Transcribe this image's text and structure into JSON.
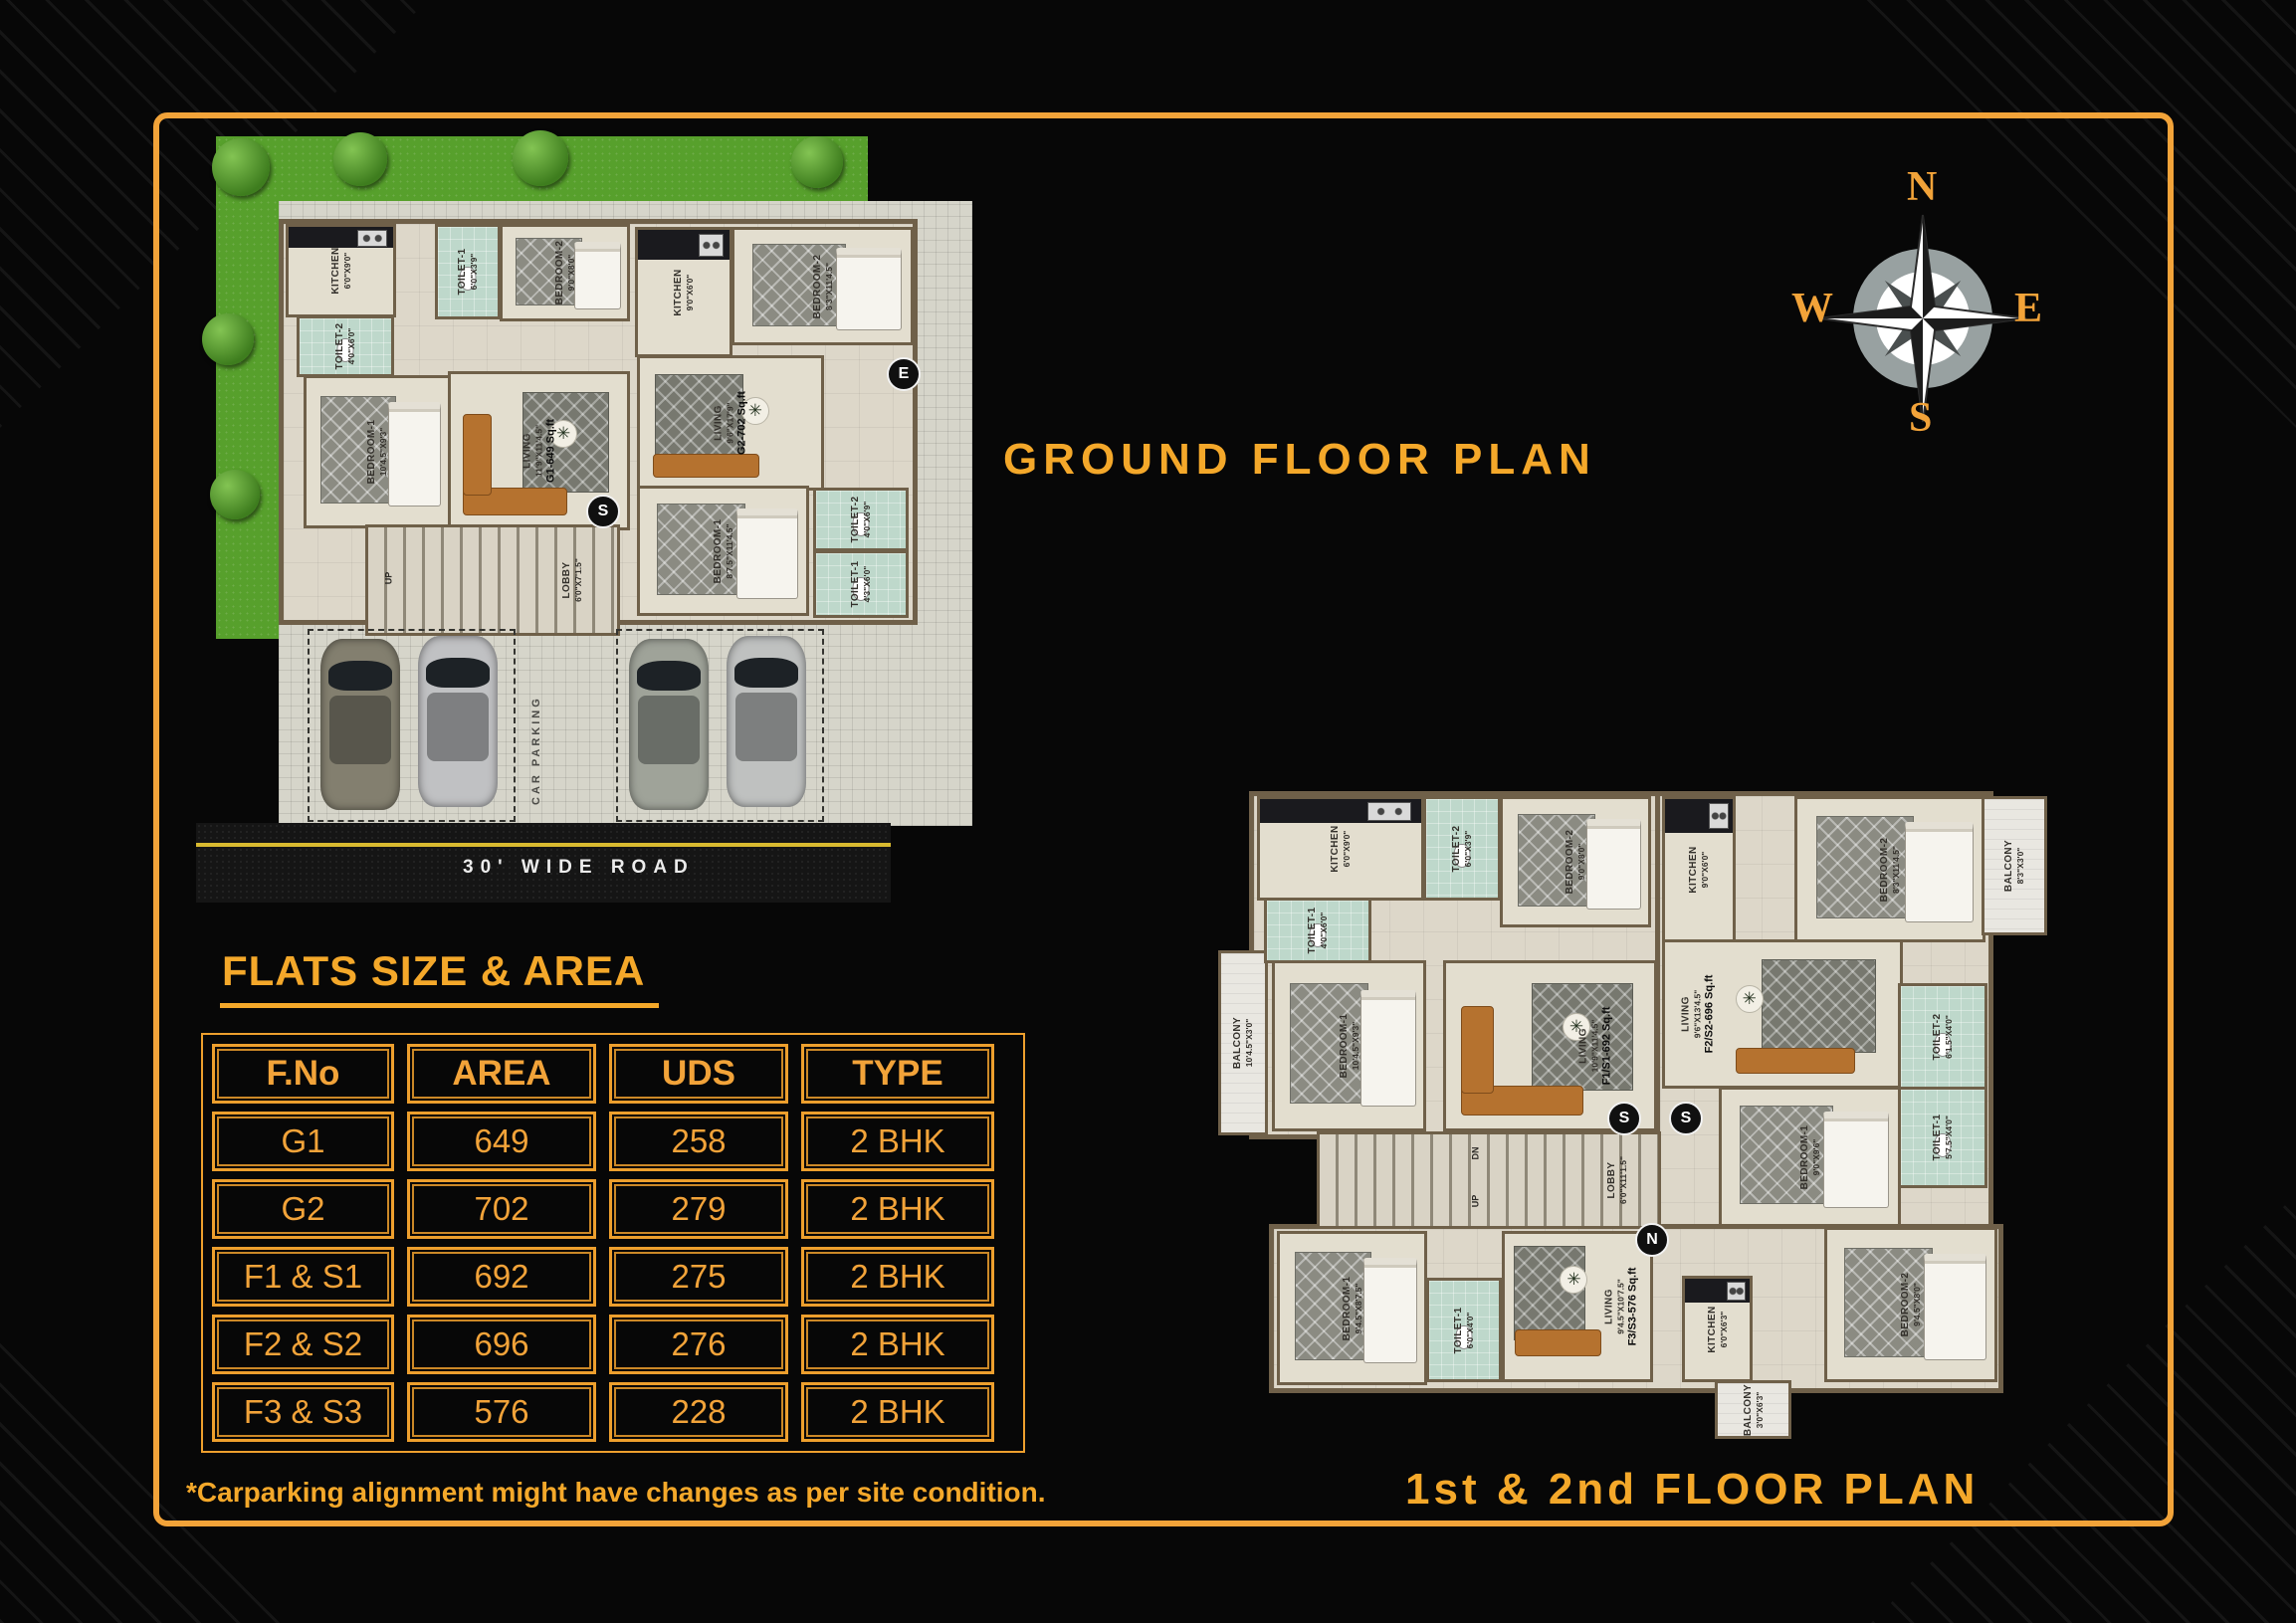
{
  "titles": {
    "ground": "GROUND FLOOR PLAN",
    "upper": "1st & 2nd FLOOR PLAN",
    "table": "FLATS SIZE & AREA",
    "note": "*Carparking alignment might have changes as per site condition."
  },
  "colors": {
    "accent": "#F2A339",
    "frame": "#F2A339",
    "toilet_floor": "#BED8CB",
    "plan_floor": "#DDD7C9",
    "wall": "#6F6049",
    "grass": "#57A02C",
    "road_line": "#D9BA30"
  },
  "icons": {
    "fan": "✳"
  },
  "compass": {
    "north": "N",
    "east": "E",
    "south": "S",
    "west": "W"
  },
  "table": {
    "headers": {
      "fno": "F.No",
      "area": "AREA",
      "uds": "UDS",
      "type": "TYPE"
    },
    "rows": [
      {
        "fno": "G1",
        "area": "649",
        "uds": "258",
        "type": "2 BHK"
      },
      {
        "fno": "G2",
        "area": "702",
        "uds": "279",
        "type": "2 BHK"
      },
      {
        "fno": "F1 & S1",
        "area": "692",
        "uds": "275",
        "type": "2 BHK"
      },
      {
        "fno": "F2 & S2",
        "area": "696",
        "uds": "276",
        "type": "2 BHK"
      },
      {
        "fno": "F3 & S3",
        "area": "576",
        "uds": "228",
        "type": "2 BHK"
      }
    ]
  },
  "ground_plan": {
    "road": "30' WIDE ROAD",
    "parking": "CAR PARKING",
    "up": "UP",
    "lobby": {
      "name": "LOBBY",
      "dims": "6'0\"X7'1.5\""
    },
    "markers": {
      "south": "S",
      "east": "E"
    },
    "g1": {
      "kitchen": {
        "name": "KITCHEN",
        "dims": "6'0\"X9'0\""
      },
      "toilet1": {
        "name": "TOILET-1",
        "dims": "6'0\"X3'9\""
      },
      "bedroom2": {
        "name": "BEDROOM-2",
        "dims": "9'0\"X8'0\""
      },
      "toilet2": {
        "name": "TOILET-2",
        "dims": "4'0\"X6'0\""
      },
      "bedroom1": {
        "name": "BEDROOM-1",
        "dims": "10'4.5\"X9'3\""
      },
      "living": {
        "name": "LIVING",
        "dims": "11'9\"X11'4.5\"",
        "area": "G1-649 Sq.ft"
      }
    },
    "g2": {
      "kitchen": {
        "name": "KITCHEN",
        "dims": "9'0\"X6'0\""
      },
      "bedroom2": {
        "name": "BEDROOM-2",
        "dims": "8'3\"X11'4.5\""
      },
      "living": {
        "name": "LIVING",
        "dims": "9'6\"X17'9\"",
        "area": "G2-702 Sq.ft"
      },
      "bedroom1": {
        "name": "BEDROOM-1",
        "dims": "8'7.5\"X11'4.5\""
      },
      "toilet2": {
        "name": "TOILET-2",
        "dims": "4'0\"X6'9\""
      },
      "toilet1": {
        "name": "TOILET-1",
        "dims": "4'3\"X6'0\""
      }
    }
  },
  "upper_plan": {
    "lobby": {
      "name": "LOBBY",
      "dims": "6'0\"X11'1.5\""
    },
    "up": "UP",
    "dn": "DN",
    "markers": {
      "south": "S",
      "north": "N"
    },
    "f1": {
      "balcony": {
        "name": "BALCONY",
        "dims": "10'4.5\"X3'0\""
      },
      "kitchen": {
        "name": "KITCHEN",
        "dims": "6'0\"X9'0\""
      },
      "toilet2": {
        "name": "TOILET-2",
        "dims": "6'0\"X3'9\""
      },
      "bedroom2": {
        "name": "BEDROOM-2",
        "dims": "9'0\"X8'0\""
      },
      "toilet1": {
        "name": "TOILET-1",
        "dims": "4'0\"X6'0\""
      },
      "bedroom1": {
        "name": "BEDROOM-1",
        "dims": "10'4.5\"X9'3\""
      },
      "living": {
        "name": "LIVING",
        "dims": "10'9\"X11'4.5\"",
        "area": "F1/S1-692 Sq.ft"
      }
    },
    "f2": {
      "kitchen": {
        "name": "KITCHEN",
        "dims": "9'0\"X6'0\""
      },
      "bedroom2": {
        "name": "BEDROOM-2",
        "dims": "8'3\"X11'4.5\""
      },
      "balcony": {
        "name": "BALCONY",
        "dims": "8'3\"X3'0\""
      },
      "living": {
        "name": "LIVING",
        "dims": "9'6\"X13'4.5\"",
        "area": "F2/S2-696 Sq.ft"
      },
      "toilet2": {
        "name": "TOILET-2",
        "dims": "6'1.5\"X4'0\""
      },
      "toilet1": {
        "name": "TOILET-1",
        "dims": "5'7.5\"X4'0\""
      },
      "bedroom1": {
        "name": "BEDROOM-1",
        "dims": "9'0\"X9'6\""
      }
    },
    "f3": {
      "bedroom1": {
        "name": "BEDROOM-1",
        "dims": "9'4.5\"X8'7.5\""
      },
      "toilet1": {
        "name": "TOILET-1",
        "dims": "6'0\"X4'0\""
      },
      "living": {
        "name": "LIVING",
        "dims": "9'4.5\"X10'7.5\"",
        "area": "F3/S3-576 Sq.ft"
      },
      "kitchen": {
        "name": "KITCHEN",
        "dims": "6'0\"X6'3\""
      },
      "balcony": {
        "name": "BALCONY",
        "dims": "3'0\"X6'3\""
      },
      "bedroom2": {
        "name": "BEDROOM-2",
        "dims": "9'4.5\"X8'0\""
      }
    }
  }
}
